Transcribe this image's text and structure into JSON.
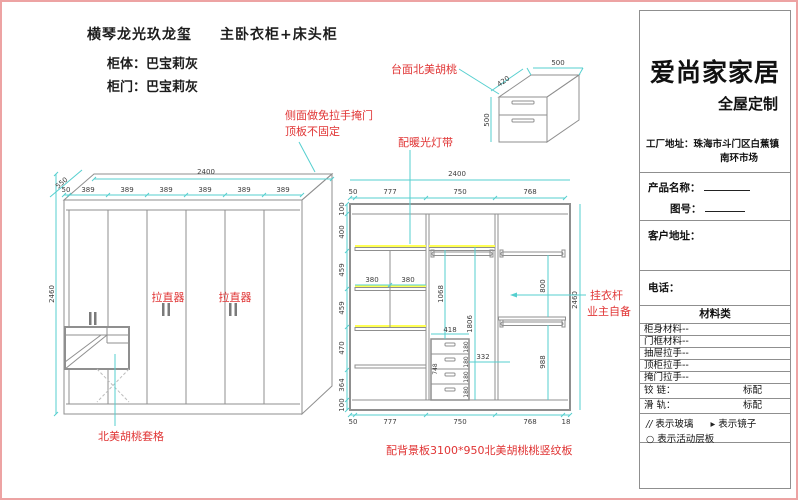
{
  "header": {
    "project_title": "横琴龙光玖龙玺",
    "subtitle": "主卧衣柜+床头柜",
    "body_color": "柜体：巴宝莉灰",
    "door_color": "柜门：巴宝莉灰"
  },
  "annotations": {
    "top_walnut": "台面北美胡桃",
    "side_door_line1": "侧面做免拉手掩门",
    "side_door_line2": "顶板不固定",
    "light_strip": "配暖光灯带",
    "straightener1": "拉直器",
    "straightener2": "拉直器",
    "hanger_line1": "挂衣杆",
    "hanger_line2": "业主自备",
    "walnut_grid": "北美胡桃套格",
    "back_panel": "配背景板3100*950北美胡桃桃竖纹板"
  },
  "front_view": {
    "width_total": "2400",
    "depth": "550",
    "height": "2460",
    "door_dims": [
      "50",
      "389",
      "389",
      "389",
      "389",
      "389",
      "389"
    ]
  },
  "inner_view": {
    "width_total": "2400",
    "height": "2460",
    "top_dims": [
      "50",
      "777",
      "750",
      "768"
    ],
    "bottom_dims": [
      "50",
      "777",
      "750",
      "768",
      "18"
    ],
    "left_dims": [
      "100",
      "400",
      "459",
      "459",
      "470",
      "364",
      "100"
    ],
    "shelf_widths": [
      "380",
      "380"
    ],
    "drawer_width": "418",
    "drawer_heights": [
      "180",
      "180",
      "180",
      "180"
    ],
    "drawer_stack_height": "748",
    "drawer_offset": "332",
    "hang_height1": "1068",
    "hang_height2": "1806",
    "rod_section1": "800",
    "rod_section2": "988"
  },
  "nightstand": {
    "width": "500",
    "depth": "420",
    "height": "500"
  },
  "panel": {
    "company": "爱尚家家居",
    "tagline": "全屋定制",
    "factory_label": "工厂地址：",
    "factory_line1": "珠海市斗门区白蕉镇",
    "factory_line2": "南环市场",
    "product_label": "产品名称：",
    "drawing_no_label": "图号：",
    "customer_label": "客户地址：",
    "phone_label": "电话：",
    "materials_header": "材料类",
    "material_rows": [
      "柜身材料--",
      "门框材料--",
      "抽屉拉手--",
      "顶柜拉手--",
      "掩门拉手--"
    ],
    "hinge_label": "铰 链：",
    "hinge_value": "标配",
    "rail_label": "滑 轨：",
    "rail_value": "标配",
    "glass_icon": "//",
    "legend_glass": "表示玻璃",
    "mirror_icon": "▸",
    "legend_mirror": "表示镜子",
    "shelf_icon": "○",
    "legend_shelf": "表示活动层板"
  },
  "colors": {
    "dimension_line": "#55cfcf",
    "outline": "#8f8f8f",
    "annotation_red": "#e03434",
    "light_strip_yellow": "#ffff54",
    "sheet_border": "#eda3a3"
  }
}
